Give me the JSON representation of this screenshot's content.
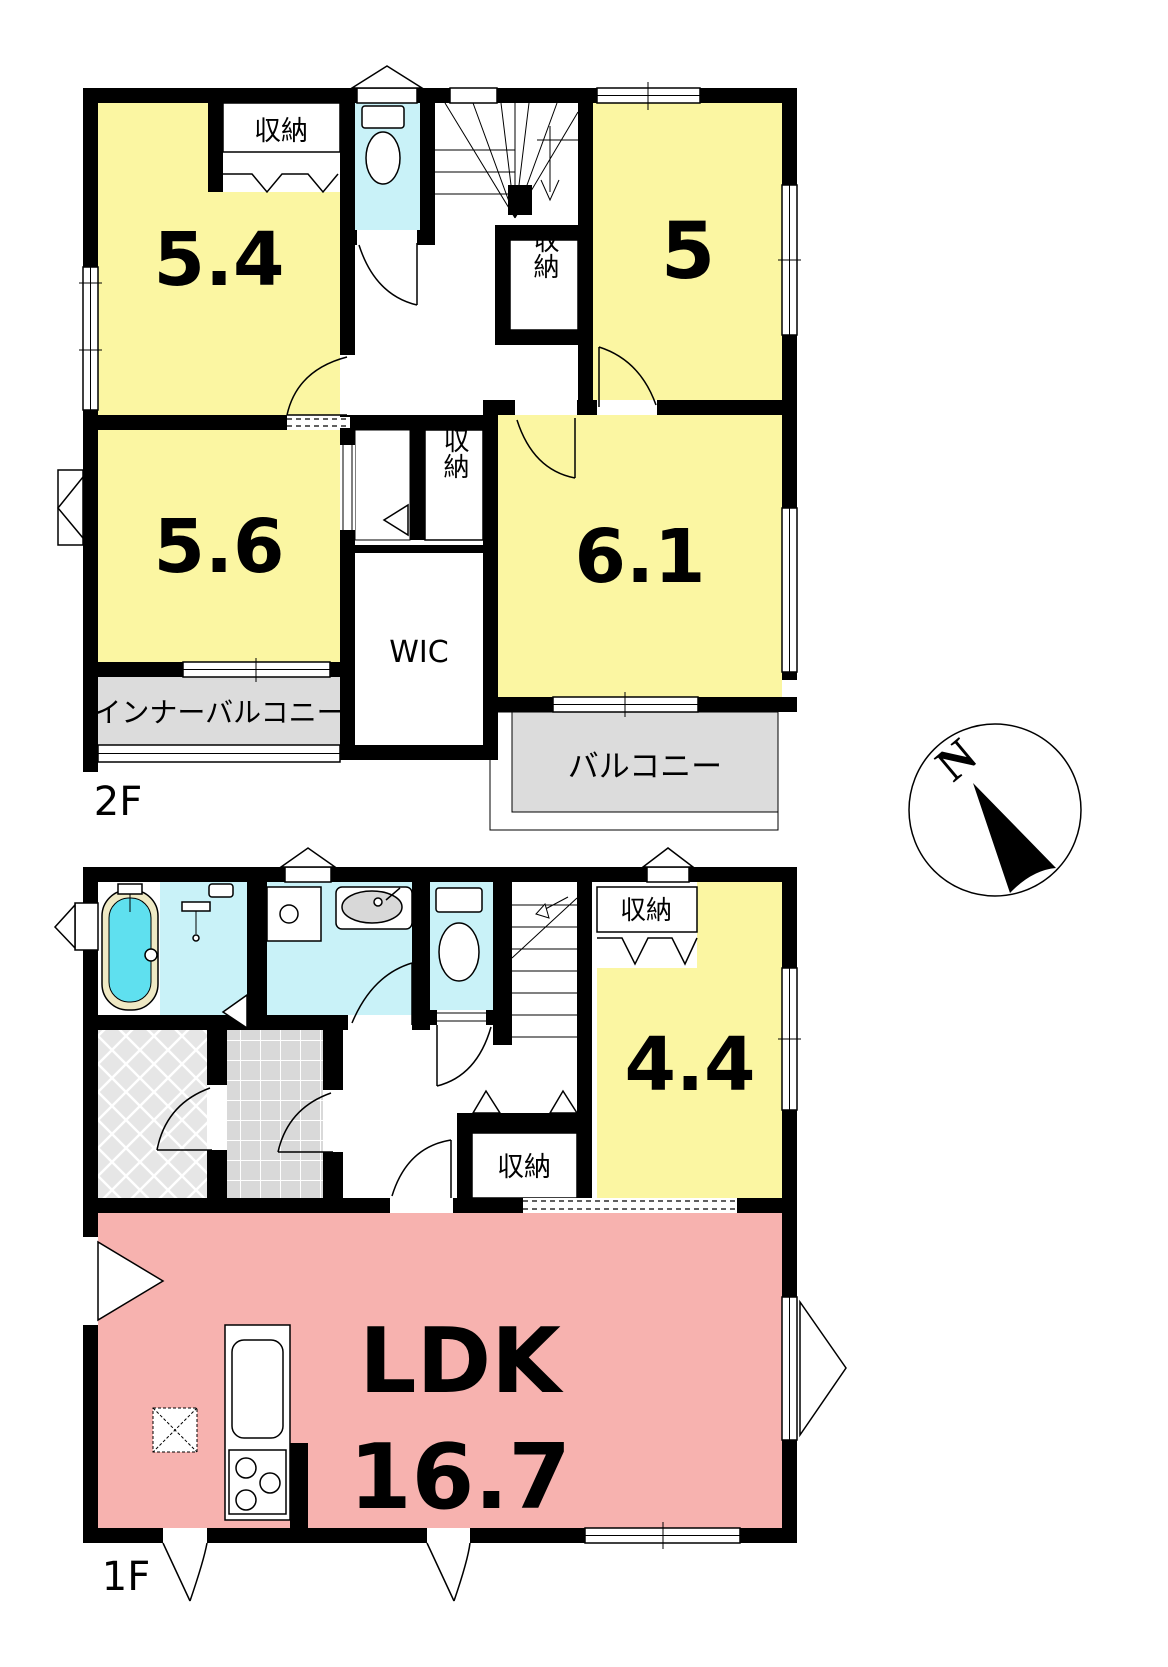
{
  "colors": {
    "wall": "#000000",
    "room_yellow": "#FBF6A2",
    "ldk_pink": "#F7B2AF",
    "wet_cyan": "#C9F2F8",
    "water_cyan": "#5FE0EF",
    "tub_rim": "#EFE9C4",
    "balcony_gray": "#DCDCDC",
    "basin_gray": "#D8D8D8"
  },
  "floor2": {
    "label": "2F",
    "room_5_4": "5.4",
    "room_5": "5",
    "room_5_6": "5.6",
    "room_6_1": "6.1",
    "closet_5_4": "収納",
    "closet_stairs": "収納",
    "closet_mid": "収納",
    "wic": "WIC",
    "inner_balcony": "インナーバルコニー",
    "balcony": "バルコニー"
  },
  "floor1": {
    "label": "1F",
    "room_4_4": "4.4",
    "closet_4_4": "収納",
    "closet_hall": "収納",
    "ldk_name": "LDK",
    "ldk_area": "16.7"
  },
  "compass": {
    "north": "N"
  }
}
